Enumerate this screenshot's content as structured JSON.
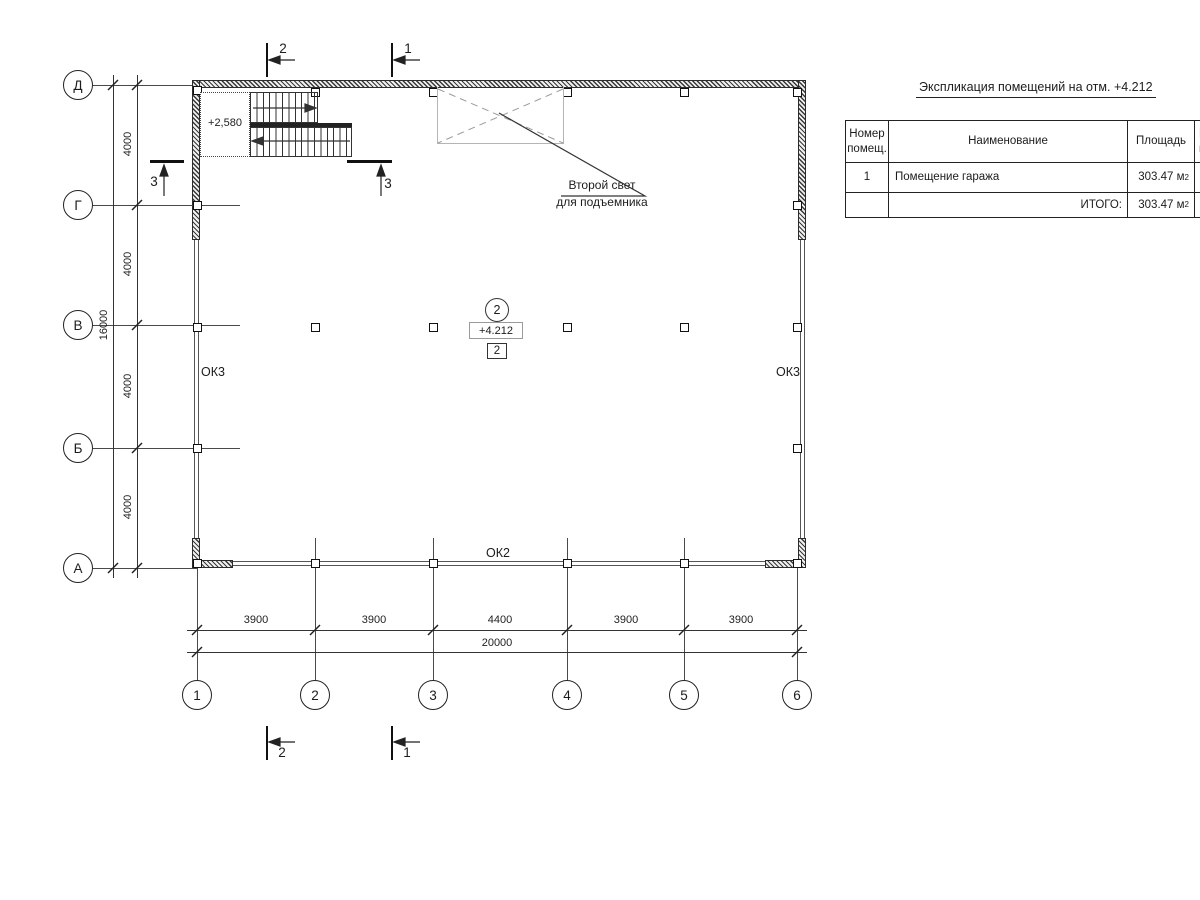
{
  "schedule": {
    "title": "Экспликация помещений на отм. +4.212",
    "header": {
      "col1a": "Номер",
      "col1b": "помещ.",
      "col2": "Наименование",
      "col3": "Площадь",
      "col4a": "К",
      "col4b": "п"
    },
    "rows": [
      {
        "num": "1",
        "name": "Помещение гаража",
        "area": "303.47 м",
        "area_sup": "2"
      }
    ],
    "total": {
      "label": "ИТОГО:",
      "area": "303.47 м",
      "area_sup": "2"
    }
  },
  "grid": {
    "rows": [
      {
        "label": "Д"
      },
      {
        "label": "Г"
      },
      {
        "label": "В"
      },
      {
        "label": "Б"
      },
      {
        "label": "А"
      }
    ],
    "cols": [
      {
        "label": "1"
      },
      {
        "label": "2"
      },
      {
        "label": "3"
      },
      {
        "label": "4"
      },
      {
        "label": "5"
      },
      {
        "label": "6"
      }
    ]
  },
  "dims": {
    "left_segments": [
      "4000",
      "4000",
      "4000",
      "4000"
    ],
    "left_total": "16000",
    "bottom_segments": [
      "3900",
      "3900",
      "4400",
      "3900",
      "3900"
    ],
    "bottom_total": "20000"
  },
  "plan": {
    "stair_elevation": "+2,580",
    "window_left": "ОК3",
    "window_right": "ОК3",
    "window_bottom": "ОК2",
    "room_tag": "2",
    "level_mark": "+4.212",
    "zone_tag": "2",
    "callout_line1": "Второй свет",
    "callout_line2": "для подъемника"
  },
  "sections": {
    "top": [
      {
        "label": "2"
      },
      {
        "label": "1"
      }
    ],
    "bottom": [
      {
        "label": "2"
      },
      {
        "label": "1"
      }
    ],
    "side": [
      {
        "label": "3"
      },
      {
        "label": "3"
      }
    ]
  }
}
